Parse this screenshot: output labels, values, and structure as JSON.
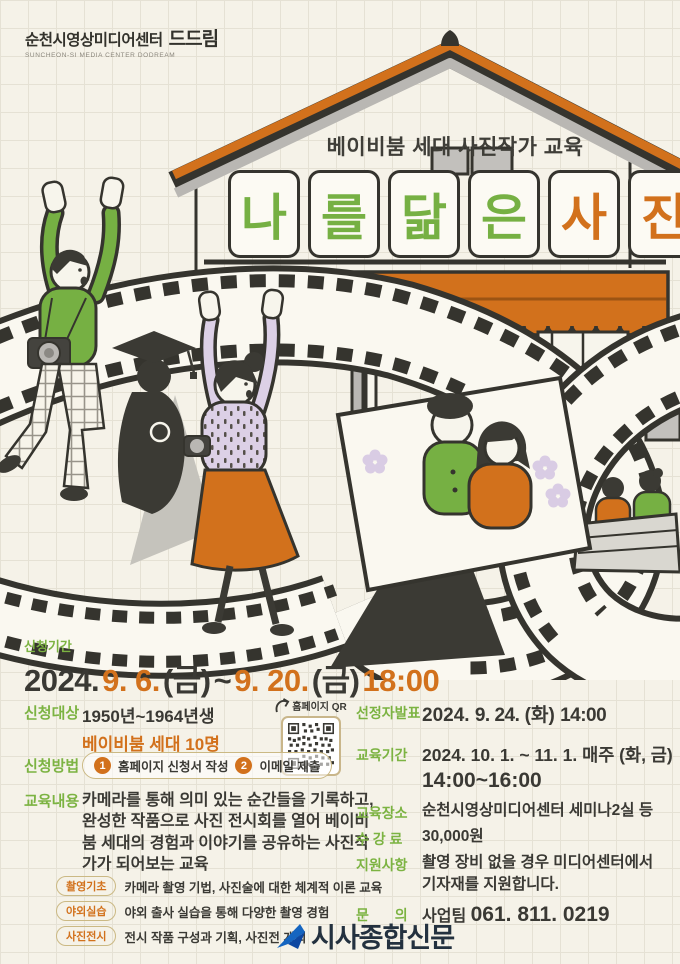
{
  "colors": {
    "green": "#76b043",
    "orange": "#d2711c",
    "dark": "#3a3934",
    "label_green": "#7cb342",
    "tan_border": "#cbb984",
    "lavender": "#d9cce4",
    "gray": "#b9b7b3",
    "watermark_blue": "#1565c0",
    "background": "#f5f2e8"
  },
  "icons": {
    "qr_arrow": "curved-arrow-icon",
    "watermark_logo": "paper-plane-icon"
  },
  "logo": {
    "name_kr": "순천시영상미디어센터",
    "mark": "드드림",
    "name_en": "SUNCHEON-SI MEDIA CENTER DODREAM"
  },
  "title": {
    "subtitle": "베이비붐 세대 사진작가 교육",
    "letters": [
      {
        "char": "나"
      },
      {
        "char": "를"
      },
      {
        "char": "닮"
      },
      {
        "char": "은"
      },
      {
        "char": "사"
      },
      {
        "char": "진"
      }
    ]
  },
  "apply_period": {
    "label": "신청기간",
    "year": "2024.",
    "start_date": "9. 6.",
    "start_day": "(금)",
    "tilde": "~",
    "end_date": "9. 20.",
    "end_day": "(금)",
    "time": "18:00"
  },
  "apply_target": {
    "label": "신청대상",
    "line1": "1950년~1964년생",
    "line2": "베이비붐 세대 10명"
  },
  "qr": {
    "label": "홈페이지 QR"
  },
  "apply_method": {
    "label": "신청방법",
    "steps": [
      {
        "num": "1",
        "text": "홈페이지 신청서 작성"
      },
      {
        "num": "2",
        "text": "이메일 제출"
      }
    ]
  },
  "edu_content": {
    "label": "교육내용",
    "desc": "카메라를 통해 의미 있는 순간들을 기록하고, 완성한 작품으로 사진 전시회를 열어 베이비붐 세대의 경험과 이야기를 공유하는 사진작가가 되어보는 교육",
    "items": [
      {
        "badge": "촬영기초",
        "text": "카메라 촬영 기법, 사진술에 대한 체계적 이론 교육"
      },
      {
        "badge": "야외실습",
        "text": "야외 출사 실습을 통해 다양한 촬영 경험"
      },
      {
        "badge": "사진전시",
        "text": "전시 작품 구성과 기획, 사진전 개최"
      }
    ]
  },
  "announcement": {
    "label": "선정자발표",
    "year": "2024.",
    "date": "9. 24.",
    "day": "(화)",
    "time": "14:00"
  },
  "edu_period": {
    "label": "교육기간",
    "year": "2024.",
    "range": "10. 1. ~ 11. 1.",
    "weekly": "매주 (화, 금)",
    "time": "14:00~16:00"
  },
  "edu_place": {
    "label": "교육장소",
    "value": "순천시영상미디어센터 세미나2실 등"
  },
  "fee": {
    "label": "수 강 료",
    "value": "30,000원"
  },
  "support": {
    "label": "지원사항",
    "line1": "촬영 장비 없을 경우 미디어센터에서",
    "line2": "기자재를 지원합니다."
  },
  "contact": {
    "label": "문 의",
    "team": "사업팀",
    "phone": "061. 811. 0219"
  },
  "watermark": {
    "text": "시사종합신문"
  }
}
